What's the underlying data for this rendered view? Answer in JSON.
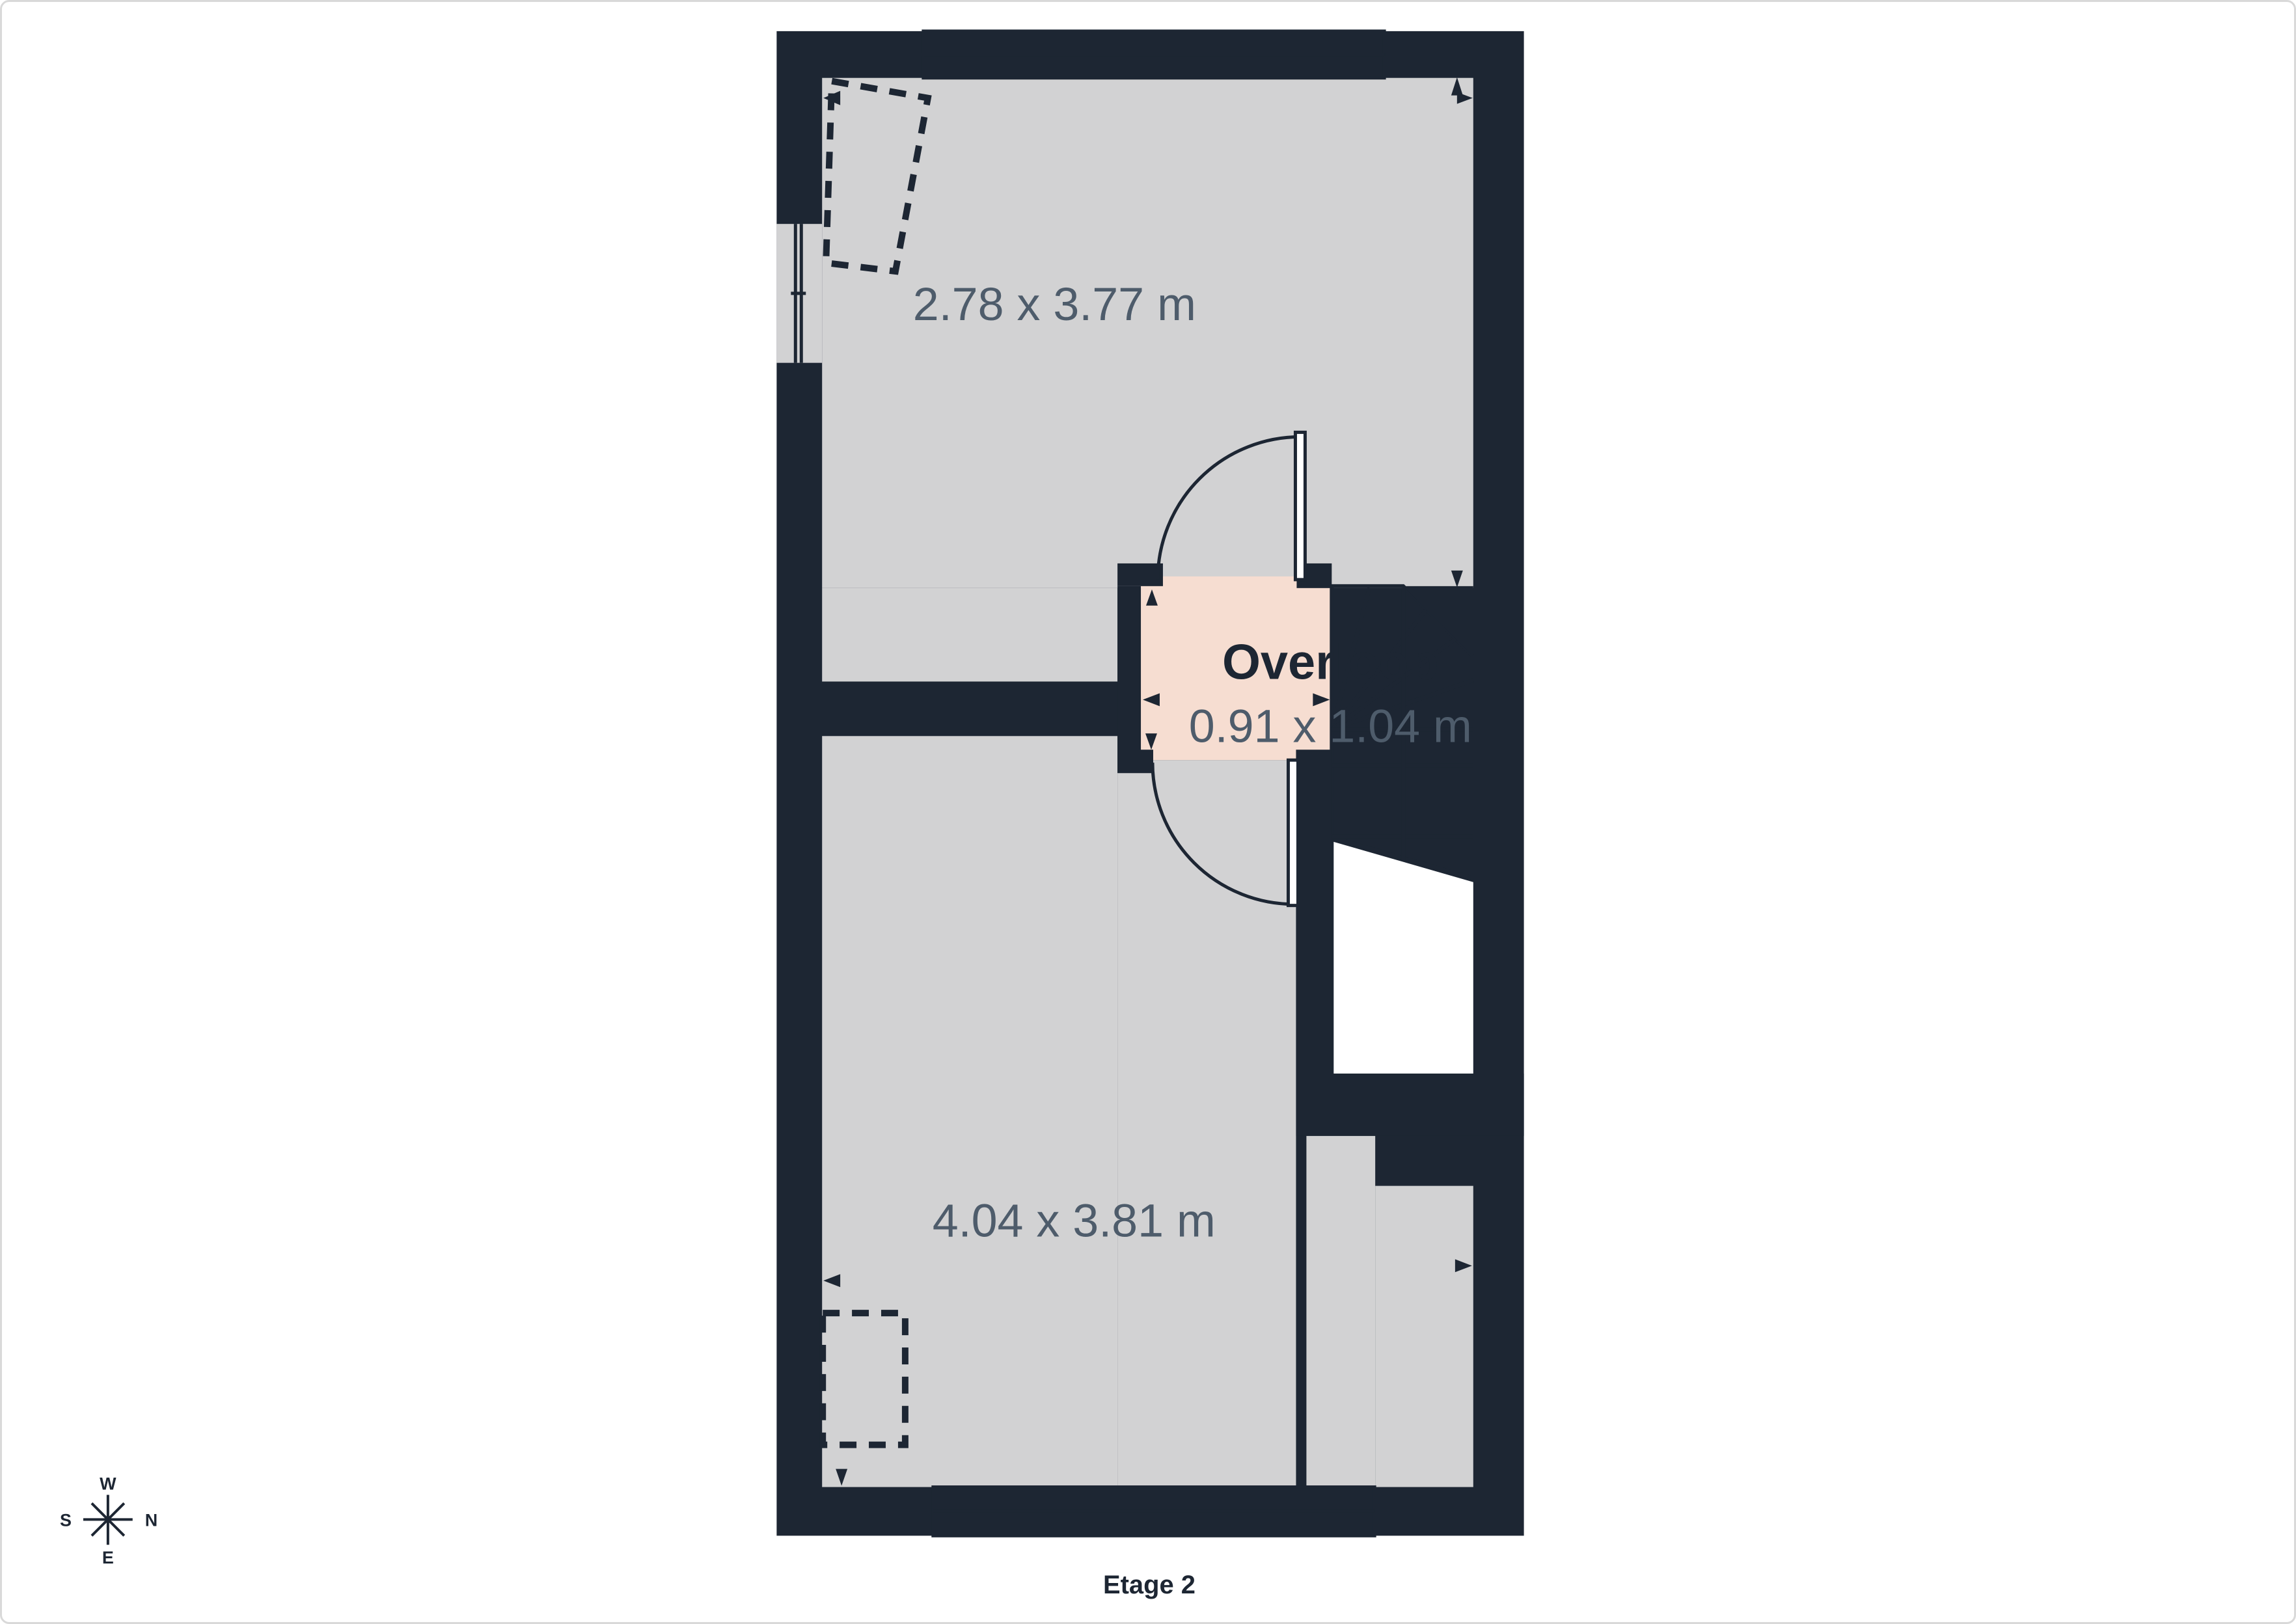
{
  "page": {
    "floor_label": "Etage 2"
  },
  "rooms": [
    {
      "id": "room-top",
      "dimensions": "2.78 x 3.77 m"
    },
    {
      "id": "landing",
      "name": "Overloop",
      "dimensions": "0.91 x 1.04 m"
    },
    {
      "id": "room-bottom",
      "dimensions": "4.04 x 3.81 m"
    }
  ],
  "compass": {
    "west": "W",
    "north": "N",
    "east": "E",
    "south": "S"
  },
  "icons": {
    "arrows": [
      "arrow-left-icon",
      "arrow-up-icon",
      "arrow-right-icon",
      "arrow-down-icon"
    ],
    "compass": "compass-rose-icon"
  },
  "colors": {
    "wall": "#1d2633",
    "room": "#d2d2d3",
    "landing": "#f6ddd1",
    "void": "#ffffff",
    "dim_text": "#4e5c6b",
    "page_border": "#d9d9d9",
    "page_bg": "#ffffff"
  }
}
